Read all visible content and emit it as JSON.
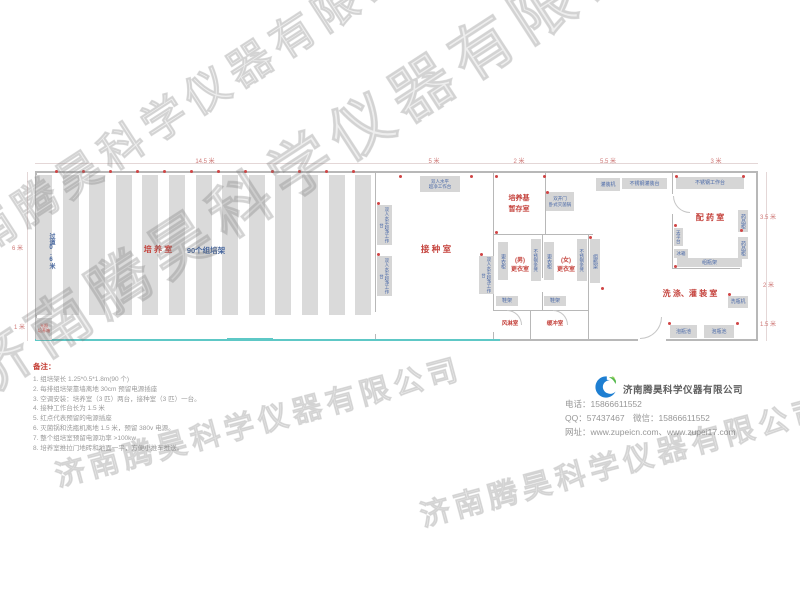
{
  "watermark": "济南腾昊科学仪器有限公司",
  "colors": {
    "wall": "#b8b8b8",
    "rack_fill": "#dadada",
    "equipment_fill": "#d6d6d6",
    "equipment_text": "#4a69a8",
    "room_label": "#c5443e",
    "outlet_dot": "#d04545",
    "sliding_door_line": "#5ec8c6",
    "dim_text": "#cf7a78",
    "note_text": "#9b9b9b",
    "logo_blue": "#1e7fd2",
    "logo_green": "#55b94e"
  },
  "plan": {
    "walls": [
      [
        35,
        171,
        723,
        2
      ],
      [
        35,
        171,
        2,
        170
      ],
      [
        756,
        171,
        2,
        170
      ],
      [
        500,
        339,
        138,
        2
      ],
      [
        666,
        339,
        92,
        2
      ],
      [
        375,
        172,
        1,
        140
      ],
      [
        375,
        334,
        1,
        7
      ],
      [
        493,
        172,
        1,
        138
      ],
      [
        493,
        332,
        1,
        9
      ],
      [
        493,
        234,
        100,
        1
      ],
      [
        545,
        172,
        1,
        62
      ],
      [
        542,
        234,
        1,
        44
      ],
      [
        542,
        292,
        1,
        18
      ],
      [
        588,
        234,
        1,
        107
      ],
      [
        493,
        310,
        96,
        1
      ],
      [
        530,
        310,
        1,
        30
      ],
      [
        672,
        172,
        1,
        22
      ],
      [
        672,
        214,
        1,
        54
      ],
      [
        672,
        268,
        68,
        1
      ]
    ],
    "cyan_lines": [
      [
        35,
        339,
        465,
        2
      ],
      [
        227,
        338,
        46,
        3
      ]
    ],
    "dim_lines": [
      [
        35,
        163,
        340,
        1
      ],
      [
        375,
        163,
        118,
        1
      ],
      [
        493,
        163,
        52,
        1
      ],
      [
        545,
        163,
        127,
        1
      ],
      [
        672,
        163,
        86,
        1
      ],
      [
        27,
        172,
        1,
        169
      ],
      [
        766,
        172,
        1,
        169
      ]
    ],
    "racks": {
      "count": 13,
      "x": 36,
      "y": 175,
      "w": 16,
      "h": 140,
      "pitch": 26.6
    },
    "equipment": [
      {
        "t": "双人水平|超净工作台",
        "x": 420,
        "y": 176,
        "w": 40,
        "h": 16,
        "fs": 4.5
      },
      {
        "t": "双人水平超净工作台",
        "x": 377,
        "y": 205,
        "w": 15,
        "h": 40,
        "v": 1,
        "fs": 4.5
      },
      {
        "t": "双人水平超净工作台",
        "x": 377,
        "y": 256,
        "w": 15,
        "h": 40,
        "v": 1,
        "fs": 4.5
      },
      {
        "t": "双人水平超净工作台",
        "x": 479,
        "y": 256,
        "w": 15,
        "h": 38,
        "v": 1,
        "fs": 4.5
      },
      {
        "t": "双开门|卧式灭菌锅",
        "x": 546,
        "y": 192,
        "w": 28,
        "h": 19,
        "fs": 4.5
      },
      {
        "t": "灌装机",
        "x": 596,
        "y": 178,
        "w": 24,
        "h": 13,
        "fs": 5
      },
      {
        "t": "不锈钢灌装台",
        "x": 622,
        "y": 178,
        "w": 45,
        "h": 11,
        "fs": 5
      },
      {
        "t": "不锈钢工作台",
        "x": 676,
        "y": 177,
        "w": 68,
        "h": 12,
        "fs": 5
      },
      {
        "t": "药品柜",
        "x": 738,
        "y": 210,
        "w": 10,
        "h": 22,
        "v": 1,
        "fs": 5
      },
      {
        "t": "药品柜",
        "x": 738,
        "y": 237,
        "w": 10,
        "h": 22,
        "v": 1,
        "fs": 5
      },
      {
        "t": "天平台",
        "x": 674,
        "y": 228,
        "w": 9,
        "h": 18,
        "v": 1,
        "fs": 4.5
      },
      {
        "t": "冰箱",
        "x": 674,
        "y": 249,
        "w": 14,
        "h": 9,
        "fs": 4.5
      },
      {
        "t": "组瓶架",
        "x": 677,
        "y": 258,
        "w": 65,
        "h": 9,
        "fs": 5
      },
      {
        "t": "组瓶架",
        "x": 590,
        "y": 239,
        "w": 10,
        "h": 44,
        "v": 1,
        "fs": 5
      },
      {
        "t": "更衣柜",
        "x": 498,
        "y": 242,
        "w": 10,
        "h": 38,
        "v": 1,
        "fs": 5
      },
      {
        "t": "不锈钢条凳",
        "x": 531,
        "y": 239,
        "w": 10,
        "h": 42,
        "v": 1,
        "fs": 4.5
      },
      {
        "t": "更衣柜",
        "x": 544,
        "y": 242,
        "w": 10,
        "h": 38,
        "v": 1,
        "fs": 5
      },
      {
        "t": "不锈钢条凳",
        "x": 577,
        "y": 239,
        "w": 10,
        "h": 42,
        "v": 1,
        "fs": 4.5
      },
      {
        "t": "鞋架",
        "x": 496,
        "y": 296,
        "w": 22,
        "h": 10,
        "fs": 5
      },
      {
        "t": "鞋架",
        "x": 544,
        "y": 296,
        "w": 22,
        "h": 10,
        "fs": 5
      },
      {
        "t": "洗瓶机",
        "x": 728,
        "y": 296,
        "w": 20,
        "h": 12,
        "fs": 5
      },
      {
        "t": "泡瓶池",
        "x": 670,
        "y": 325,
        "w": 27,
        "h": 13,
        "fs": 5
      },
      {
        "t": "泡瓶池",
        "x": 704,
        "y": 325,
        "w": 30,
        "h": 13,
        "fs": 5
      },
      {
        "t": "光照|培养箱",
        "x": 36,
        "y": 318,
        "w": 16,
        "h": 22,
        "red": 1,
        "fs": 4
      }
    ],
    "labels": [
      {
        "t": "培 养 室",
        "x": 158,
        "y": 244,
        "fs": 8
      },
      {
        "t": "90个组培架",
        "x": 206,
        "y": 244.5,
        "fs": 7.5,
        "c": "blue"
      },
      {
        "t": "过道0.6米",
        "x": 48,
        "y": 233,
        "fs": 6,
        "c": "blue",
        "v": 1
      },
      {
        "t": "接 种 室",
        "x": 436,
        "y": 243,
        "fs": 8.5
      },
      {
        "t": "培养基|暂存室",
        "x": 519,
        "y": 194,
        "fs": 7
      },
      {
        "t": "(男)|更衣室",
        "x": 520,
        "y": 257,
        "fs": 6
      },
      {
        "t": "(女)|更衣室",
        "x": 566,
        "y": 257,
        "fs": 6
      },
      {
        "t": "风淋室",
        "x": 510,
        "y": 320,
        "fs": 5.5
      },
      {
        "t": "缓冲室",
        "x": 555,
        "y": 320,
        "fs": 5.5
      },
      {
        "t": "配 药 室",
        "x": 710,
        "y": 212,
        "fs": 8
      },
      {
        "t": "洗 涤、灌 装 室",
        "x": 690,
        "y": 288,
        "fs": 8
      }
    ],
    "dims": [
      {
        "t": "14.5 米",
        "x": 205,
        "y": 156
      },
      {
        "t": "5 米",
        "x": 434,
        "y": 156
      },
      {
        "t": "2 米",
        "x": 519,
        "y": 156
      },
      {
        "t": "5.5 米",
        "x": 608,
        "y": 156
      },
      {
        "t": "3 米",
        "x": 716,
        "y": 156
      },
      {
        "t": "6 米",
        "x": 12,
        "y": 243,
        "side": 1
      },
      {
        "t": "1 米",
        "x": 14,
        "y": 322,
        "side": 1
      },
      {
        "t": "3.5 米",
        "x": 760,
        "y": 212,
        "side": 1
      },
      {
        "t": "2 米",
        "x": 763,
        "y": 280,
        "side": 1
      },
      {
        "t": "1.5 米",
        "x": 760,
        "y": 319,
        "side": 1
      }
    ],
    "outlets": [
      [
        55,
        170
      ],
      [
        82,
        170
      ],
      [
        109,
        170
      ],
      [
        136,
        170
      ],
      [
        163,
        170
      ],
      [
        190,
        170
      ],
      [
        217,
        170
      ],
      [
        244,
        170
      ],
      [
        271,
        170
      ],
      [
        298,
        170
      ],
      [
        325,
        170
      ],
      [
        352,
        170
      ],
      [
        399,
        175
      ],
      [
        470,
        175
      ],
      [
        377,
        202
      ],
      [
        377,
        253
      ],
      [
        480,
        253
      ],
      [
        495,
        175
      ],
      [
        543,
        175
      ],
      [
        495,
        231
      ],
      [
        546,
        191
      ],
      [
        589,
        236
      ],
      [
        675,
        175
      ],
      [
        742,
        175
      ],
      [
        674,
        224
      ],
      [
        740,
        229
      ],
      [
        674,
        265
      ],
      [
        601,
        287
      ],
      [
        728,
        293
      ],
      [
        668,
        322
      ],
      [
        736,
        322
      ]
    ],
    "arcs": [
      {
        "x": 507,
        "y": 310,
        "s": 15,
        "o": "tr"
      },
      {
        "x": 553,
        "y": 310,
        "s": 15,
        "o": "tr"
      },
      {
        "x": 640,
        "y": 317,
        "s": 22,
        "o": "br"
      },
      {
        "x": 673,
        "y": 196,
        "s": 17,
        "o": "bl"
      }
    ]
  },
  "notes": {
    "title": "备注：",
    "items": [
      "1. 组培架长 1.25*0.5*1.8m(90 个)",
      "2. 每排组培架靠墙离地 30cm 预留电源插座",
      "3. 空调安装：培养室（3 匹）两台，接种室（3 匹）一台。",
      "4. 接种工作台长为 1.5 米",
      "5. 红点代表预留的电源插座",
      "6. 灭菌锅和洗瓶机离地 1.5 米，预留 380v 电源。",
      "7. 整个组培室预留电源功率 >100kw",
      "8. 培养室推拉门地砖和地面一平，方便小推车推送。"
    ]
  },
  "company": {
    "name": "济南腾昊科学仪器有限公司",
    "lines": [
      "电话：15866611552",
      "QQ：57437467　微信：15866611552",
      "网址：www.zupeicn.com、www.zupei17.com"
    ]
  }
}
